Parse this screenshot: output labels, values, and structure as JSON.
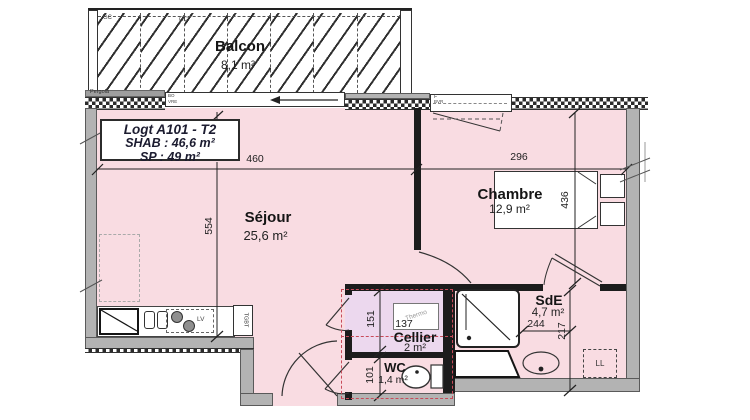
{
  "title_block": {
    "logement": "Logt A101 - T2",
    "shab": "SHAB : 46,6 m²",
    "sp": "SP : 49 m²"
  },
  "rooms": {
    "balcon": {
      "name": "Balcon",
      "area": "8,1 m²"
    },
    "sejour": {
      "name": "Séjour",
      "area": "25,6 m²"
    },
    "chambre": {
      "name": "Chambre",
      "area": "12,9 m²"
    },
    "sde": {
      "name": "SdE",
      "area": "4,7 m²"
    },
    "cellier": {
      "name": "Cellier",
      "area": "2 m²"
    },
    "wc": {
      "name": "WC",
      "area": "1,4 m²"
    }
  },
  "dimensions": {
    "sejour_width": "460",
    "chambre_width": "296",
    "sejour_depth": "554",
    "chambre_depth": "436",
    "cellier_depth": "151",
    "cellier_width": "137",
    "sde_width": "244",
    "sde_depth": "217",
    "wc_depth": "101"
  },
  "annotations": {
    "pergola": "Pergola",
    "gc_left": "GC",
    "gc_right": "GC",
    "bo": "BO",
    "vre": "VRE",
    "window_f": "F",
    "window_bvr": "BVR",
    "lv": "LV",
    "tgbt": "TGBT",
    "thermo": "Thermo",
    "ll": "LL"
  },
  "colors": {
    "room_fill": "#f9dce2",
    "cellier_fill": "#ecd8ee",
    "wall_gray": "#b3b3b3",
    "partition": "#1c1c1c",
    "red_dashed": "#c84b5a"
  }
}
